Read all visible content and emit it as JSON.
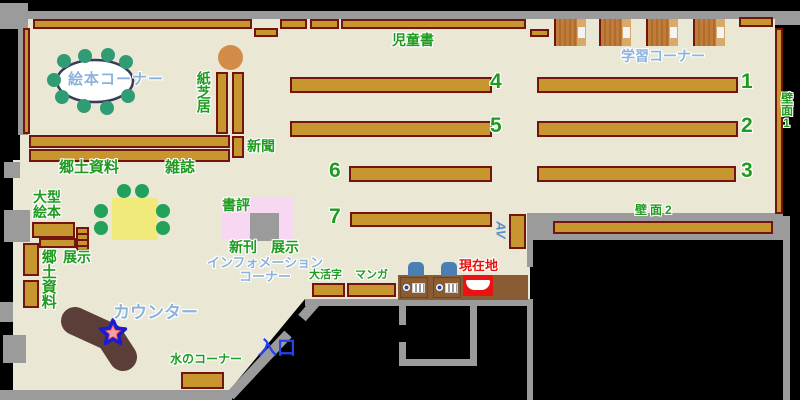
{
  "labels": {
    "ehon_corner": "絵本コーナー",
    "kamishibai": "紙芝居",
    "newspaper": "新聞",
    "local_materials_top": "郷土資料",
    "magazines": "雑誌",
    "children_books": "児童書",
    "study_corner": "学習コーナー",
    "wall_1": "壁面1",
    "wall_2": "壁面2",
    "large_picture_books": "大型絵本",
    "display_left": "展示",
    "local_materials_left": "郷土資料",
    "book_review": "書評",
    "new_books": "新刊",
    "display_center": "展示",
    "information_corner_line1": "インフォメーション",
    "information_corner_line2": "コーナー",
    "large_print": "大活字",
    "manga": "マンガ",
    "current_location": "現在地",
    "av": "AV",
    "counter": "カウンター",
    "water_corner": "水のコーナー",
    "entrance": "入口"
  },
  "shelf_numbers": [
    "1",
    "2",
    "3",
    "4",
    "5",
    "6",
    "7"
  ],
  "colors": {
    "floor": "#EAE8D5",
    "wall_gray": "#9B9B9B",
    "shelf_fill": "#C8962F",
    "shelf_border": "#72150E",
    "label_green": "#1F9B1F",
    "label_lightblue": "#8CB3DC",
    "entrance_blue": "#2244F0",
    "current_location_red": "#EC1212",
    "counter_brown": "#5C3E39",
    "table_yellow": "#F0EA7A",
    "chair_green": "#21A159",
    "display_pink": "#F8D7F3",
    "stool_orange": "#D28C48"
  }
}
